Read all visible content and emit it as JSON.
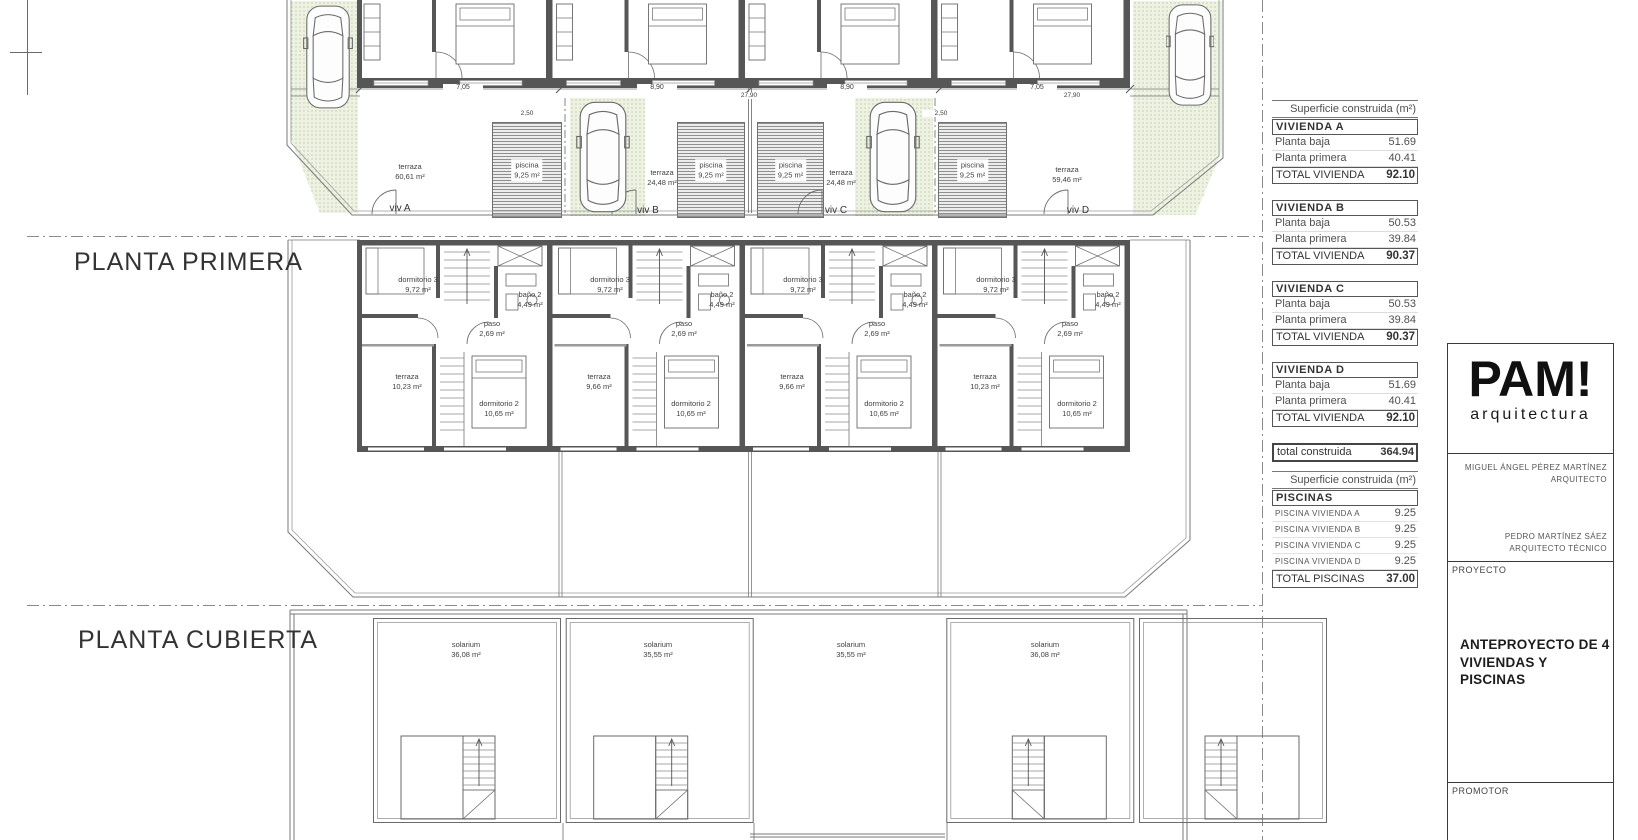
{
  "colors": {
    "wall": "#565656",
    "line": "#6a6a6a",
    "green_area": "#edf2e2",
    "text": "#3f3f3f"
  },
  "plans": {
    "ground": {
      "dims": {
        "d1": "7,05",
        "d2": "8,90",
        "d3": "8,90",
        "d4": "7,05",
        "t1": "27,90",
        "t2": "27,90",
        "p1": "2,50",
        "p2": "2,50"
      },
      "units": [
        {
          "viv": "viv A",
          "terraza_name": "terraza",
          "terraza_area": "60,61 m²",
          "piscina_name": "piscina",
          "piscina_area": "9,25 m²"
        },
        {
          "viv": "viv B",
          "terraza_name": "terraza",
          "terraza_area": "24,48 m²",
          "piscina_name": "piscina",
          "piscina_area": "9,25 m²"
        },
        {
          "viv": "viv C",
          "terraza_name": "terraza",
          "terraza_area": "24,48 m²",
          "piscina_name": "piscina",
          "piscina_area": "9,25 m²"
        },
        {
          "viv": "viv D",
          "terraza_name": "terraza",
          "terraza_area": "59,46 m²",
          "piscina_name": "piscina",
          "piscina_area": "9,25 m²"
        }
      ]
    },
    "primera": {
      "title": "PLANTA PRIMERA",
      "units": [
        {
          "dorm3": "dormitorio 3",
          "dorm3_area": "9,72 m²",
          "bano": "baño 2",
          "bano_area": "4,49 m²",
          "paso": "paso",
          "paso_area": "2,69 m²",
          "terraza": "terraza",
          "terraza_area": "10,23 m²",
          "dorm2": "dormitorio 2",
          "dorm2_area": "10,65 m²"
        },
        {
          "dorm3": "dormitorio 3",
          "dorm3_area": "9,72 m²",
          "bano": "baño 2",
          "bano_area": "4,49 m²",
          "paso": "paso",
          "paso_area": "2,69 m²",
          "terraza": "terraza",
          "terraza_area": "9,66 m²",
          "dorm2": "dormitorio 2",
          "dorm2_area": "10,65 m²"
        },
        {
          "dorm3": "dormitorio 3",
          "dorm3_area": "9,72 m²",
          "bano": "baño 2",
          "bano_area": "4,49 m²",
          "paso": "paso",
          "paso_area": "2,69 m²",
          "terraza": "terraza",
          "terraza_area": "9,66 m²",
          "dorm2": "dormitorio 2",
          "dorm2_area": "10,65 m²"
        },
        {
          "dorm3": "dormitorio 3",
          "dorm3_area": "9,72 m²",
          "bano": "baño 2",
          "bano_area": "4,49 m²",
          "paso": "paso",
          "paso_area": "2,69 m²",
          "terraza": "terraza",
          "terraza_area": "10,23 m²",
          "dorm2": "dormitorio 2",
          "dorm2_area": "10,65 m²"
        }
      ]
    },
    "cubierta": {
      "title": "PLANTA CUBIERTA",
      "units": [
        {
          "name": "solarium",
          "area": "36,08 m²"
        },
        {
          "name": "solarium",
          "area": "35,55 m²"
        },
        {
          "name": "solarium",
          "area": "35,55 m²"
        },
        {
          "name": "solarium",
          "area": "36,08 m²"
        }
      ]
    }
  },
  "tables": {
    "viviendas": {
      "header": "Superficie construida (m²)",
      "groups": [
        {
          "name": "VIVIENDA A",
          "rows": [
            {
              "label": "Planta baja",
              "value": "51.69"
            },
            {
              "label": "Planta primera",
              "value": "40.41"
            }
          ],
          "total_label": "TOTAL VIVIENDA",
          "total_value": "92.10"
        },
        {
          "name": "VIVIENDA B",
          "rows": [
            {
              "label": "Planta baja",
              "value": "50.53"
            },
            {
              "label": "Planta primera",
              "value": "39.84"
            }
          ],
          "total_label": "TOTAL VIVIENDA",
          "total_value": "90.37"
        },
        {
          "name": "VIVIENDA C",
          "rows": [
            {
              "label": "Planta baja",
              "value": "50.53"
            },
            {
              "label": "Planta primera",
              "value": "39.84"
            }
          ],
          "total_label": "TOTAL VIVIENDA",
          "total_value": "90.37"
        },
        {
          "name": "VIVIENDA D",
          "rows": [
            {
              "label": "Planta baja",
              "value": "51.69"
            },
            {
              "label": "Planta primera",
              "value": "40.41"
            }
          ],
          "total_label": "TOTAL VIVIENDA",
          "total_value": "92.10"
        }
      ],
      "grand_label": "total construida",
      "grand_value": "364.94"
    },
    "piscinas": {
      "header": "Superficie construida (m²)",
      "title": "PISCINAS",
      "rows": [
        {
          "label": "PISCINA VIVIENDA A",
          "value": "9.25"
        },
        {
          "label": "PISCINA VIVIENDA B",
          "value": "9.25"
        },
        {
          "label": "PISCINA VIVIENDA C",
          "value": "9.25"
        },
        {
          "label": "PISCINA VIVIENDA D",
          "value": "9.25"
        }
      ],
      "total_label": "TOTAL PISCINAS",
      "total_value": "37.00"
    }
  },
  "titleblock": {
    "logo": "PAM!",
    "logo_sub": "arquitectura",
    "architect": "MIGUEL ÁNGEL PÉREZ MARTÍNEZ",
    "architect_role": "ARQUITECTO",
    "tech": "PEDRO MARTÍNEZ SÁEZ",
    "tech_role": "ARQUITECTO TÉCNICO",
    "proyecto_label": "PROYECTO",
    "proyecto_line1": "ANTEPROYECTO DE  4",
    "proyecto_line2": "VIVIENDAS Y PISCINAS",
    "promotor_label": "PROMOTOR"
  }
}
